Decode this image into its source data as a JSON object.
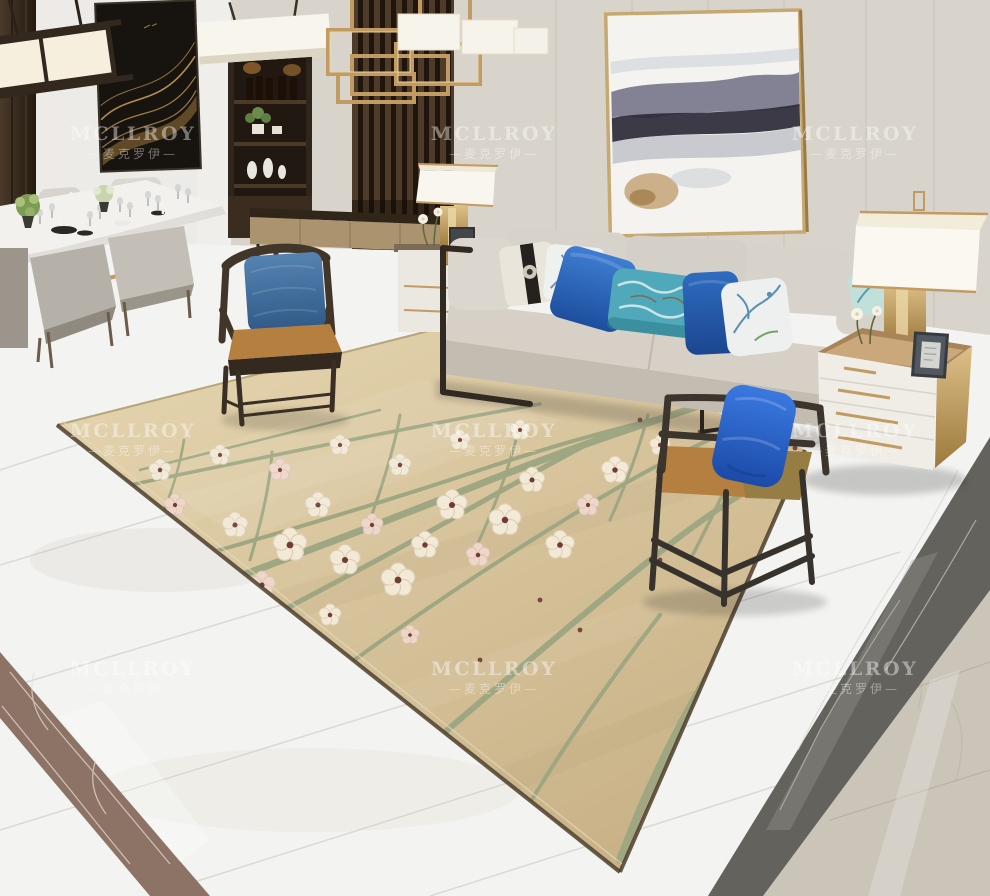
{
  "scene": {
    "description": "Interior product photo: beige plum-blossom area rug in a modern living room with grey sofa, blue pillows, wooden armchairs, dining set and gold accents",
    "objects": [
      "pendant-lights",
      "gold-chandelier",
      "wave-artwork",
      "wine-shelf",
      "slat-partition",
      "abstract-painting",
      "dining-set",
      "fabric-sofa",
      "throw-pillows",
      "wooden-armchair",
      "metal-armchair",
      "gold-nightstand",
      "table-lamps",
      "floral-area-rug",
      "marble-floor-borders"
    ]
  },
  "watermark": {
    "line1": "MCLLROY",
    "line2": "—麦克罗伊—"
  },
  "palette": {
    "wall": "#d9d4cb",
    "wall_light": "#ecebe7",
    "wood_dark": "#3a2d20",
    "gold": "#c29b63",
    "sofa": "#d6d0c6",
    "sofa_front": "#c2bcb1",
    "pillow_teal": "#4fa9ba",
    "seat_caramel": "#b5803f",
    "rug_base": "#ddcba2",
    "branch": "#9fa682",
    "blossom": "#f2e9d6",
    "blossom_center": "#713c33",
    "floor_white": "#f3f3f1",
    "marble_brown": "#8d7366",
    "marble_grey": "#63625c",
    "marble_greige": "#cbc4b9"
  }
}
